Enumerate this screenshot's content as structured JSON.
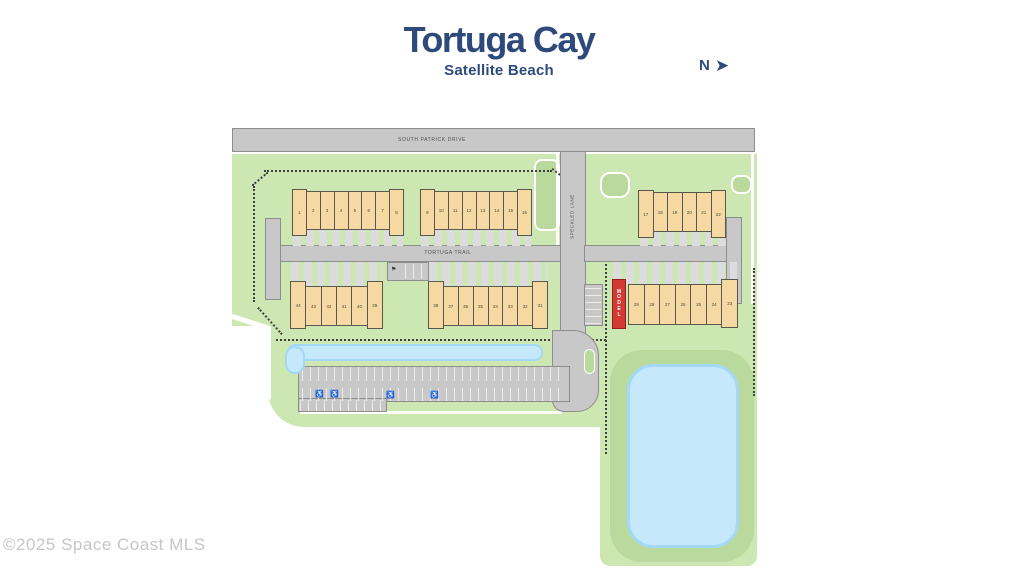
{
  "header": {
    "title": "Tortuga Cay",
    "subtitle": "Satellite Beach",
    "north_label": "N",
    "north_arrow": "➤"
  },
  "footer": {
    "copyright": "©2025 Space Coast MLS"
  },
  "roads": {
    "south_patrick_drive": "SOUTH PATRICK DRIVE",
    "tortuga_trail": "TORTUGA TRAIL",
    "speckled_lane": "SPECKLED LANE"
  },
  "site": {
    "model_unit_label": "MODEL",
    "building_rows": [
      {
        "name": "north-west-row",
        "units": [
          "1",
          "2",
          "3",
          "4",
          "5",
          "6",
          "7",
          "8"
        ]
      },
      {
        "name": "north-middle-row",
        "units": [
          "9",
          "10",
          "11",
          "12",
          "13",
          "14",
          "15",
          "16"
        ]
      },
      {
        "name": "north-east-row",
        "units": [
          "17",
          "18",
          "19",
          "20",
          "21",
          "22"
        ]
      },
      {
        "name": "south-east-row",
        "units": [
          "29",
          "28",
          "27",
          "26",
          "25",
          "24",
          "23"
        ]
      },
      {
        "name": "south-middle-row",
        "units": [
          "38",
          "37",
          "36",
          "35",
          "34",
          "33",
          "32",
          "31"
        ]
      },
      {
        "name": "south-west-row",
        "units": [
          "44",
          "43",
          "42",
          "41",
          "40",
          "39"
        ]
      }
    ]
  },
  "icons": {
    "handicap": "♿",
    "kiosk": "⚑"
  },
  "colors": {
    "navy": "#2d4a7a",
    "road_gray": "#c8c8c8",
    "green_light": "#cde7b3",
    "green_medium": "#bad99c",
    "building_tan": "#f6d8a2",
    "water_blue": "#c6e8fb",
    "model_red": "#d23a33",
    "copyright_gray": "#c6c6c6"
  }
}
